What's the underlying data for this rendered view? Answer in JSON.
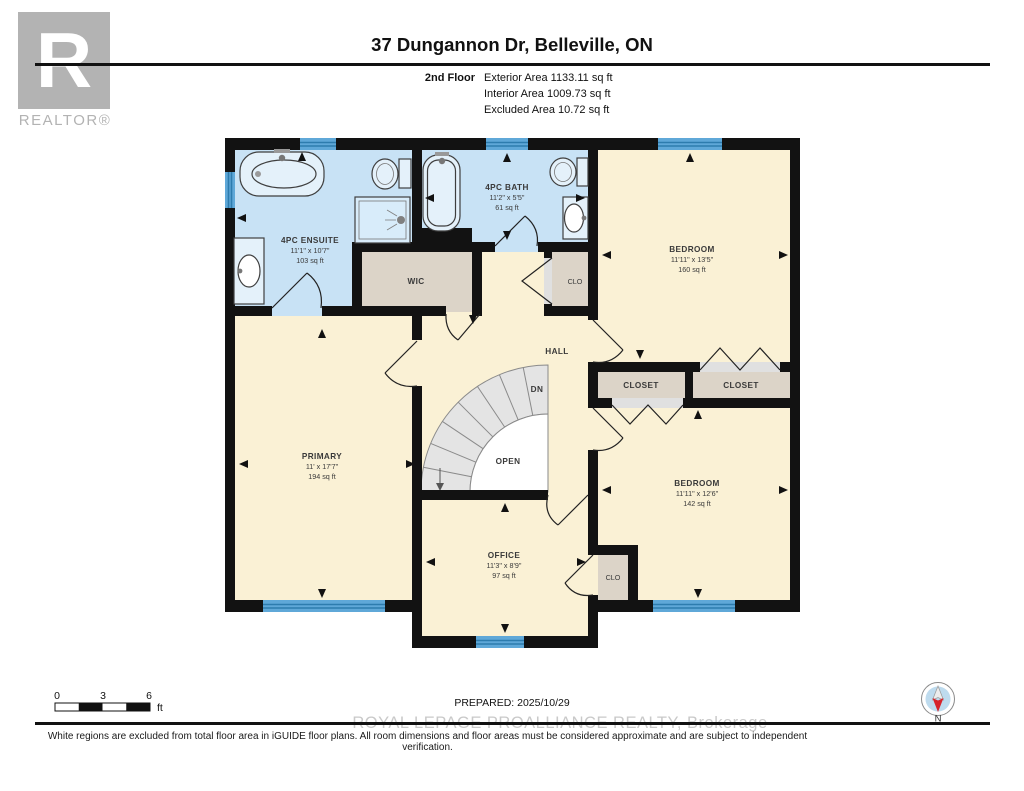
{
  "header": {
    "logo_r": "R",
    "logo_text": "REALTOR®",
    "title": "37 Dungannon Dr, Belleville, ON",
    "floor_label": "2nd Floor",
    "exterior_area": "Exterior Area 1133.11 sq ft",
    "interior_area": "Interior Area 1009.73 sq ft",
    "excluded_area": "Excluded Area 10.72 sq ft"
  },
  "rooms": {
    "ensuite": {
      "name": "4PC ENSUITE",
      "dims": "11'1\" x 10'7\"",
      "area": "103 sq ft"
    },
    "bath": {
      "name": "4PC BATH",
      "dims": "11'2\" x 5'5\"",
      "area": "61 sq ft"
    },
    "wic": {
      "name": "WIC"
    },
    "clo_top": {
      "name": "CLO"
    },
    "bedroom1": {
      "name": "BEDROOM",
      "dims": "11'11\" x 13'5\"",
      "area": "160 sq ft"
    },
    "hall": {
      "name": "HALL"
    },
    "stairs_dn": "DN",
    "stairs_open": "OPEN",
    "closet1": {
      "name": "CLOSET"
    },
    "closet2": {
      "name": "CLOSET"
    },
    "primary": {
      "name": "PRIMARY",
      "dims": "11' x 17'7\"",
      "area": "194 sq ft"
    },
    "bedroom2": {
      "name": "BEDROOM",
      "dims": "11'11\" x 12'6\"",
      "area": "142 sq ft"
    },
    "office": {
      "name": "OFFICE",
      "dims": "11'3\" x 8'9\"",
      "area": "97 sq ft"
    },
    "clo_bottom": {
      "name": "CLO"
    }
  },
  "footer": {
    "scale": {
      "tick0": "0",
      "tick3": "3",
      "tick6": "6",
      "unit": "ft"
    },
    "prepared": "PREPARED: 2025/10/29",
    "compass_north": "N",
    "watermark": "ROYAL LEPAGE PROALLIANCE REALTY, Brokerage",
    "disclaimer": "White regions are excluded from total floor area in iGUIDE floor plans. All room dimensions and floor areas must be considered approximate and are subject to independent verification."
  },
  "colors": {
    "bathroom_blue": "#c8e2f5",
    "cream": "#faf1d5",
    "tan": "#dcd4c8",
    "wall": "#121212",
    "window_blue": "#5fa8d8",
    "window_stripe": "#2d7cae",
    "stair_gray": "#e4e4e4",
    "compass_red": "#d6232b"
  }
}
